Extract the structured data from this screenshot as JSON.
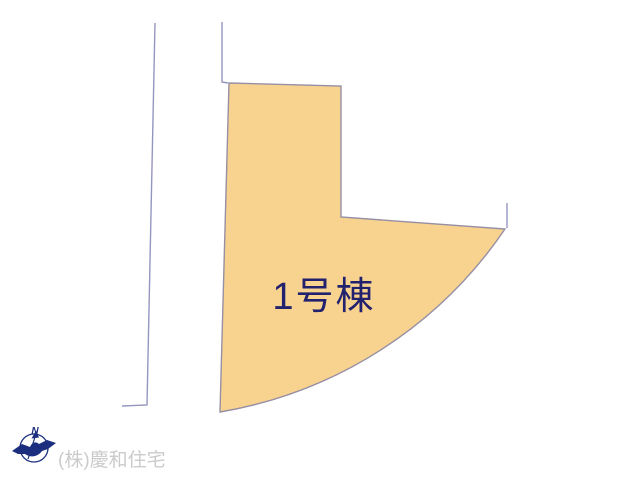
{
  "canvas": {
    "width": 640,
    "height": 480,
    "background": "#ffffff"
  },
  "site_plan": {
    "parcel": {
      "label": "1号棟",
      "fill": "#f8d390",
      "stroke": "#978fa4",
      "outline_path": "M 229,83 L 341,86 L 341,217 L 505,229 A 431 431 0 0 1 220,412 Z",
      "label_color": "#21216e",
      "label_font_size": 38,
      "label_x": 324,
      "label_y": 309
    },
    "boundary_lines": {
      "color": "#9596c0",
      "segments": [
        {
          "name": "left-road-line",
          "points": "155,23 147,405 122,406"
        },
        {
          "name": "upper-lot-line",
          "points": "222,22 222,82 228,83"
        },
        {
          "name": "right-lot-line",
          "points": "507,203 507,228"
        }
      ]
    },
    "compass": {
      "label": "N",
      "icon": "compass-north-bird",
      "color": "#1c2f7f",
      "cx": 34,
      "cy": 448,
      "r": 14,
      "label_x": 35,
      "label_y": 434,
      "label_font_size": 10
    },
    "footer": {
      "company": "(株)慶和住宅",
      "color": "#cbcbcb",
      "font_size": 19,
      "x": 58,
      "y": 466
    }
  }
}
